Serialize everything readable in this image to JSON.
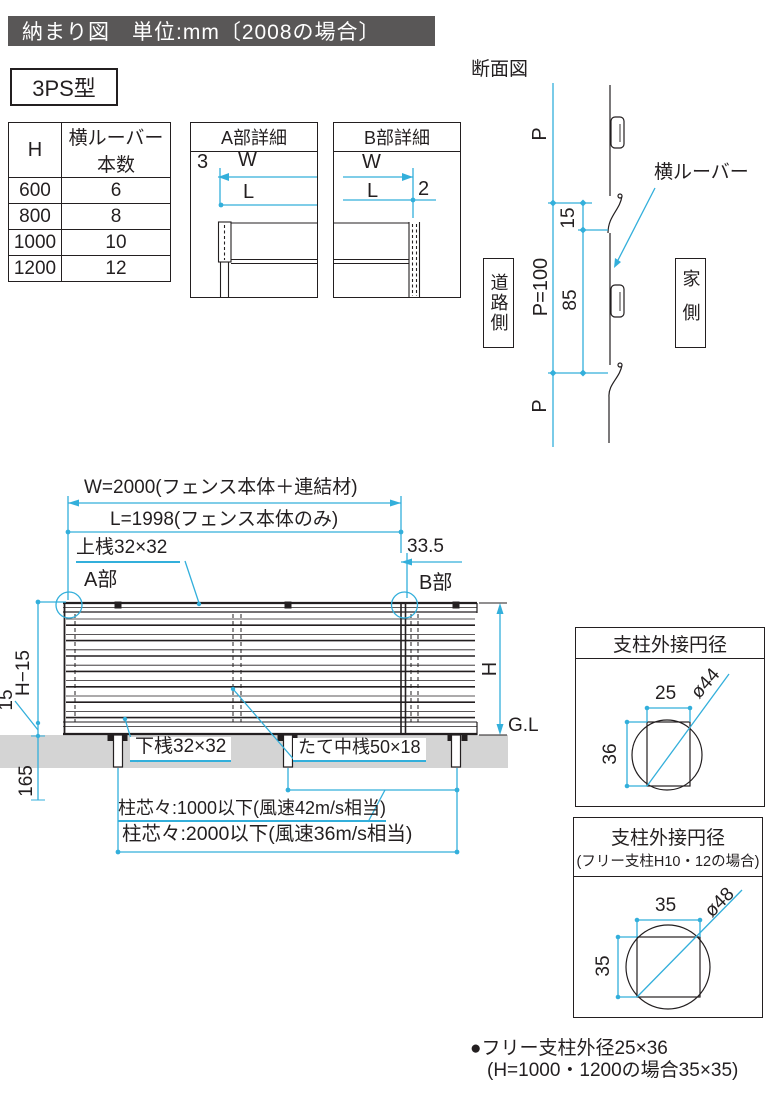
{
  "title": "納まり図　単位:mm〔2008の場合〕",
  "model_label": "3PS型",
  "spec_table": {
    "headers": [
      "H",
      "横ルーバー本数"
    ],
    "rows": [
      [
        "600",
        "6"
      ],
      [
        "800",
        "8"
      ],
      [
        "1000",
        "10"
      ],
      [
        "1200",
        "12"
      ]
    ]
  },
  "detail_a": {
    "title": "A部詳細",
    "dim_3": "3",
    "dim_w": "W",
    "dim_l": "L"
  },
  "detail_b": {
    "title": "B部詳細",
    "dim_w": "W",
    "dim_l": "L",
    "dim_2": "2"
  },
  "section": {
    "title": "断面図",
    "p_top": "P",
    "p_bottom": "P",
    "p100": "P=100",
    "dim_15": "15",
    "dim_85": "85",
    "louver_label": "横ルーバー",
    "road_side": "道路側",
    "house_side": "家側"
  },
  "elevation": {
    "dim_w": "W=2000(フェンス本体＋連結材)",
    "dim_l": "L=1998(フェンス本体のみ)",
    "top_rail": "上桟32×32",
    "dim_335": "33.5",
    "part_a": "A部",
    "part_b": "B部",
    "dim_h15": "H−15",
    "dim_15": "15",
    "dim_165": "165",
    "dim_h": "H",
    "gl": "G.L",
    "bottom_rail": "下桟32×32",
    "mid_rail": "たて中桟50×18",
    "span_1000": "柱芯々:1000以下(風速42m/s相当)",
    "span_2000": "柱芯々:2000以下(風速36m/s相当)"
  },
  "post_box_1": {
    "title": "支柱外接円径",
    "dim_w": "25",
    "dim_h": "36",
    "dia": "ø44"
  },
  "post_box_2": {
    "title": "支柱外接円径",
    "subtitle": "(フリー支柱H10・12の場合)",
    "dim_w": "35",
    "dim_h": "35",
    "dia": "ø48"
  },
  "footnote": {
    "line1": "●フリー支柱外径25×36",
    "line2": "(H=1000・1200の場合35×35)"
  },
  "colors": {
    "accent": "#33afdb",
    "ink": "#231f20",
    "ground": "#d4d4d4",
    "title_bg": "#595757"
  }
}
